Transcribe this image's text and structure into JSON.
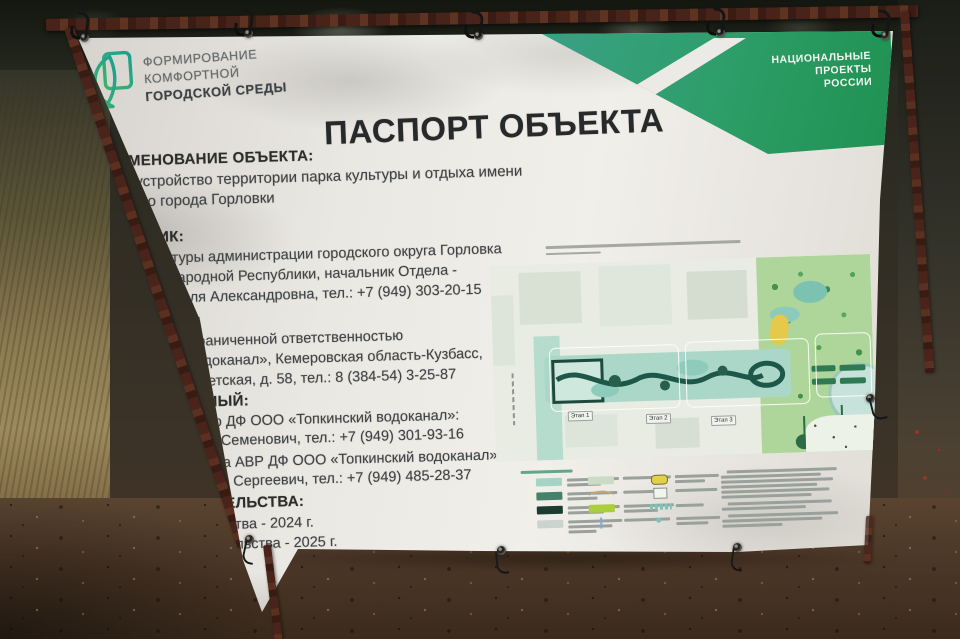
{
  "banner": {
    "program_logo": {
      "lines": [
        "ФОРМИРОВАНИЕ",
        "КОМФОРТНОЙ",
        "ГОРОДСКОЙ СРЕДЫ"
      ]
    },
    "national_projects_badge": {
      "lines": [
        "НАЦИОНАЛЬНЫЕ",
        "ПРОЕКТЫ",
        "РОССИИ"
      ]
    },
    "title": "ПАСПОРТ ОБЪЕКТА",
    "sections": [
      {
        "heading": "НАИМЕНОВАНИЕ ОБЪЕКТА:",
        "lines": [
          "Благоустройство территории парка культуры и отдыха имени Горького города Горловки"
        ]
      },
      {
        "heading": "ЗАКАЗЧИК:",
        "lines": [
          "Отдел культуры администрации городского округа Горловка",
          "Донецкой Народной Республики, начальник Отдела -",
          "Короткова Неля Александровна, тел.: +7 (949) 303-20-15"
        ]
      },
      {
        "heading": "ПОДРЯДЧИК:",
        "lines": [
          "Общество с ограниченной ответственностью",
          "«Топкинский водоканал», Кемеровская область-Кузбасс,",
          "г. Топки, ул. Советская, д. 58, тел.: 8 (384-54) 3-25-87"
        ]
      },
      {
        "heading": "ОТВЕТСТВЕННЫЙ:",
        "lines": [
          "Главный инженер ДФ ООО «Топкинский водоканал»:",
          "Кошевой Андрей Семенович, тел.: +7 (949) 301-93-16",
          "Начальник участка АВР ДФ ООО «Топкинский водоканал»:",
          "Макашин Дмитрий Сергеевич, тел.: +7 (949) 485-28-37"
        ]
      },
      {
        "heading": "СРОКИ СТРОИТЕЛЬСТВА:",
        "lines": [
          "Начало строительства - 2024 г.",
          "Окончание строительства - 2025 г."
        ]
      }
    ]
  },
  "site_plan": {
    "stage_labels": [
      "Этап 1",
      "Этап 2",
      "Этап 3"
    ],
    "legend_swatches": [
      "#a7d3c4",
      "#47816c",
      "#1c3b31",
      "#ccd2ce",
      "#cbdcc6",
      "#a9cf3d",
      "#e3cf4a",
      "#c9a96e",
      "#7fa9d6",
      "#7cc4b8"
    ]
  },
  "colors": {
    "banner_white": "#e9e7e2",
    "brand_green": "#2f9e63",
    "brand_teal": "#2aa489",
    "title_text": "#27292b",
    "body_text": "#3f4345",
    "frame_rust": "#4a241b",
    "map_boulevard_teal": "#abd7c9",
    "map_path_green": "#1d5747",
    "map_park_green": "#aed69a"
  }
}
